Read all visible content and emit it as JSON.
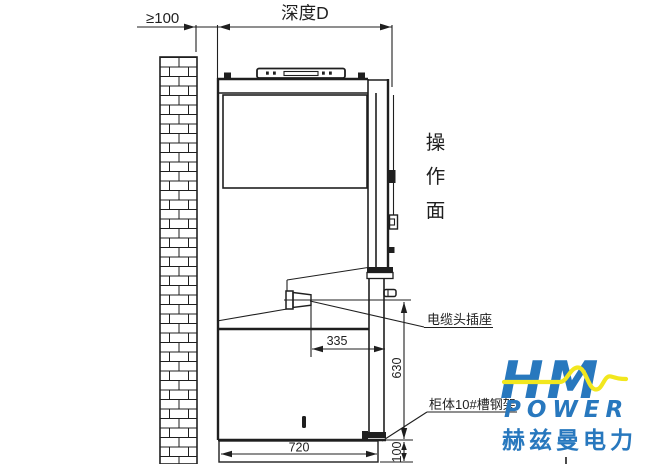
{
  "dimensions": {
    "wall_gap": "≥100",
    "depth": "深度D",
    "socket_offset": "335",
    "socket_height": "630",
    "base_depth": "720",
    "base_height": "100"
  },
  "labels": {
    "operation_face_chars": [
      "操",
      "作",
      "面"
    ],
    "cable_socket": "电缆头插座",
    "channel_frame": "柜体10#槽钢架"
  },
  "logo": {
    "monogram": "HM",
    "name": "POWER",
    "chinese_name": "赫兹曼电力",
    "blue": "#2878BE",
    "yellow": "#F2E71E"
  },
  "colors": {
    "line": "#1f1f1f",
    "background": "#ffffff"
  }
}
